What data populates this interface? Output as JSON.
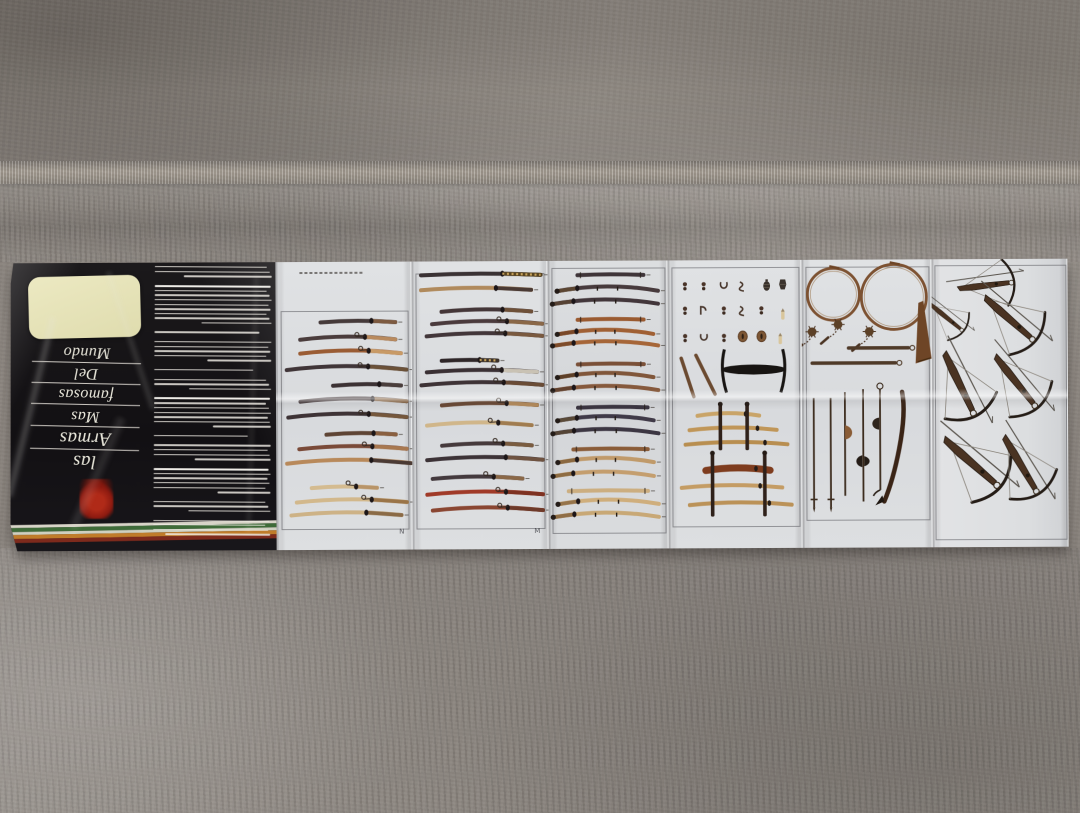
{
  "scene": {
    "alt": "Unfolded vintage weapons brochure lying upside-down on a gray carpet",
    "carpet_color": "#8d8781",
    "paper_color": "#dcdee0"
  },
  "brochure": {
    "cover": {
      "title_printed": "las Armas Mas famosas Del Mundo",
      "title_lines": [
        "Mundo",
        "Del",
        "famosas",
        "Mas",
        "Armas",
        "las"
      ],
      "background": "#141214",
      "cream_panel_color": "#e9e6bc",
      "emblem_color": "#9a1c10",
      "stripes": [
        "#d8d4c8",
        "#3e6b38",
        "#cfd0c0",
        "#c07c2a",
        "#7e2a1c"
      ],
      "stripe_heights": [
        3,
        4,
        3,
        4,
        4
      ],
      "text_block": {
        "line_color": "#f0ede5",
        "paragraphs": [
          {
            "n": 3,
            "last": 0.75
          },
          {
            "n": 9,
            "last": 0.6,
            "boldFirst": true
          },
          {
            "n": 1,
            "last": 0.9
          },
          {
            "n": 5,
            "last": 0.55
          },
          {
            "n": 1,
            "last": 0.85
          },
          {
            "n": 3,
            "last": 0.7
          },
          {
            "n": 7,
            "last": 0.5,
            "boldFirst": true
          },
          {
            "n": 1,
            "last": 0.8
          },
          {
            "n": 4,
            "last": 0.65
          },
          {
            "n": 6,
            "last": 0.45,
            "boldFirst": true
          },
          {
            "n": 3,
            "last": 0.7
          },
          {
            "n": 4,
            "last": 0.9
          }
        ]
      }
    },
    "plates": [
      {
        "id": "swords-plate-1",
        "corner_mark": "N",
        "w": 136,
        "border": {
          "l": 4,
          "t": 17,
          "r": 96.5,
          "b": 92.5
        },
        "caption": {
          "x": 18,
          "y": 3.6,
          "len": 46
        },
        "swords": [
          [
            21,
            33,
            88,
            "#453a3a",
            "#7d5a40",
            -1,
            ""
          ],
          [
            27,
            18,
            88,
            "#4a3c3c",
            "#b98a5e",
            -2,
            "t"
          ],
          [
            31.8,
            18,
            92,
            "#9a5c34",
            "#c89a66",
            -2,
            "t"
          ],
          [
            37.5,
            8,
            96,
            "#403538",
            "#6b5138",
            -2.5,
            "t"
          ],
          [
            43,
            42,
            92,
            "#3c3234",
            "#4a3e3c",
            -1,
            ""
          ],
          [
            48.5,
            18,
            96,
            "#453a3c",
            "#8a6848",
            -2,
            ""
          ],
          [
            54,
            9,
            96,
            "#3e3336",
            "#75573c",
            -2.5,
            "t"
          ],
          [
            60,
            37,
            88,
            "#5e4434",
            "#8a6040",
            -1,
            ""
          ],
          [
            65,
            17,
            96,
            "#7a4a38",
            "#a87850",
            -2,
            "t"
          ],
          [
            70,
            8,
            99,
            "#b8895a",
            "#4a3a34",
            -2.5,
            ""
          ],
          [
            78.5,
            26,
            74,
            "#d4bb90",
            "#b89468",
            -1,
            "t"
          ],
          [
            83.5,
            15,
            96,
            "#d2b88c",
            "#9a7448",
            -2,
            "t"
          ],
          [
            88,
            11,
            92,
            "#cdb286",
            "#8a6a46",
            -2,
            ""
          ]
        ]
      },
      {
        "id": "swords-plate-2",
        "corner_mark": "M",
        "w": 136,
        "border": {
          "l": 3,
          "t": 4,
          "r": 96,
          "b": 92.5
        },
        "swords": [
          [
            4.8,
            7,
            95,
            "#3a3234",
            "#57431f",
            -1,
            "b"
          ],
          [
            10,
            7,
            88,
            "#b08a5c",
            "#4a3a34",
            -1.5,
            ""
          ],
          [
            17.5,
            22,
            88,
            "#443638",
            "#6e5038",
            -1.5,
            ""
          ],
          [
            21.8,
            15,
            96,
            "#4a3a3c",
            "#8a6848",
            -2,
            "t"
          ],
          [
            26,
            11,
            96,
            "#42363a",
            "#7a5a40",
            -2,
            "t"
          ],
          [
            34.5,
            22,
            63,
            "#2e2628",
            "#3a3028",
            -0.5,
            "b"
          ],
          [
            38.5,
            11,
            92,
            "#3a3034",
            "#c9c2b4",
            -1.5,
            "t"
          ],
          [
            43,
            7,
            96,
            "#3e3336",
            "#6a4c36",
            -2,
            "t"
          ],
          [
            50,
            22,
            92,
            "#6a4834",
            "#b68c5c",
            -1.5,
            "t"
          ],
          [
            57,
            11,
            88,
            "#d0b68a",
            "#a07c50",
            -2,
            "t"
          ],
          [
            64,
            22,
            88,
            "#463a3c",
            "#7a5c40",
            -1.5,
            "t"
          ],
          [
            69,
            11,
            96,
            "#3c3236",
            "#6e5240",
            -2,
            ""
          ],
          [
            75.5,
            15,
            81,
            "#443a3e",
            "#8a6848",
            -1.5,
            "t"
          ],
          [
            81,
            11,
            96,
            "#a03a28",
            "#7e3222",
            -2,
            "t"
          ],
          [
            86.5,
            15,
            96,
            "#8a4632",
            "#6e3a2a",
            -2,
            "t"
          ]
        ]
      },
      {
        "id": "swords-plate-3",
        "corner_mark": "",
        "w": 120,
        "border": {
          "l": 3,
          "t": 2.5,
          "r": 97,
          "b": 94
        },
        "swords": [
          [
            5,
            25,
            80,
            "#3e3438",
            "#3e3438",
            -0.5,
            "s"
          ],
          [
            10.5,
            8,
            92,
            "#473a3c",
            "#5c4632",
            -3,
            "Lh"
          ],
          [
            15,
            4,
            92,
            "#42363a",
            "#564234",
            -3,
            "Lh"
          ],
          [
            20.5,
            25,
            80,
            "#9a5a30",
            "#9a5a30",
            -0.5,
            "s"
          ],
          [
            25.5,
            8,
            88,
            "#a06034",
            "#7a4828",
            -3,
            "Lh"
          ],
          [
            29.5,
            4,
            92,
            "#a66638",
            "#7e4c2a",
            -3,
            "Lh"
          ],
          [
            36,
            25,
            80,
            "#7a5038",
            "#7a5038",
            -0.5,
            "s"
          ],
          [
            40.5,
            8,
            88,
            "#80563a",
            "#5e4028",
            -3,
            "Lh"
          ],
          [
            45,
            4,
            92,
            "#86593c",
            "#634330",
            -3,
            "Lh"
          ],
          [
            51,
            25,
            83,
            "#3a3440",
            "#3a3440",
            -0.5,
            "s"
          ],
          [
            55.5,
            8,
            88,
            "#403a48",
            "#5a4a38",
            -3,
            "Lh"
          ],
          [
            60,
            4,
            92,
            "#3c3642",
            "#544436",
            -3,
            "Lh"
          ],
          [
            65.5,
            21,
            83,
            "#8a5c38",
            "#8a5c38",
            -0.5,
            "s"
          ],
          [
            70,
            8,
            88,
            "#c09a6a",
            "#8a6840",
            -3,
            "Lh"
          ],
          [
            74.8,
            4,
            88,
            "#c49e6e",
            "#8e6c42",
            -3,
            "Lh"
          ],
          [
            80,
            17,
            83,
            "#ccae80",
            "#ccae80",
            -0.5,
            "s"
          ],
          [
            84.5,
            8,
            92,
            "#cfae7c",
            "#96744a",
            -3,
            "Lh"
          ],
          [
            89,
            4,
            92,
            "#c8a876",
            "#906e46",
            -3,
            "Lh"
          ]
        ]
      },
      {
        "id": "fittings-and-racks-plate",
        "corner_mark": "",
        "w": 134,
        "border": {
          "l": 3,
          "t": 2.5,
          "r": 97,
          "b": 92
        },
        "fits": [
          [
            13,
            9,
            "knot"
          ],
          [
            27,
            9,
            "knot"
          ],
          [
            42,
            9,
            "stirrup"
          ],
          [
            57,
            9,
            "curve"
          ],
          [
            74,
            9,
            "grenade"
          ],
          [
            86,
            8.5,
            "vase"
          ],
          [
            13,
            17.5,
            "knot"
          ],
          [
            27,
            17.5,
            "hook"
          ],
          [
            42,
            17.5,
            "knot"
          ],
          [
            57,
            17.5,
            "curve"
          ],
          [
            70,
            17.5,
            "knot"
          ],
          [
            86,
            19,
            "bullet"
          ],
          [
            13,
            27,
            "knot"
          ],
          [
            27,
            27,
            "stirrup"
          ],
          [
            42,
            27,
            "knot"
          ],
          [
            56,
            26.5,
            "tsuba"
          ],
          [
            70,
            26.5,
            "tsuba"
          ],
          [
            84,
            27.5,
            "bullet"
          ]
        ],
        "sheaths": [
          [
            10,
            34,
            14,
            72
          ],
          [
            21,
            33,
            15,
            64
          ]
        ],
        "stand": {
          "cx": 64,
          "cy": 38,
          "rx": 24,
          "py1": 31,
          "py2": 46
        },
        "racks": [
          {
            "posts": [
              39,
              59
            ],
            "y1": 50,
            "y2": 66,
            "swords": [
              [
                54,
                22,
                68,
                "#c9a468"
              ],
              [
                59,
                16,
                81,
                "#c09658"
              ],
              [
                64,
                13,
                89,
                "#b88e50"
              ]
            ]
          },
          {
            "posts": [
              33,
              72
            ],
            "y1": 67,
            "y2": 89,
            "swords": [
              [
                73,
                28,
                76,
                "#7e3c1e",
                7
              ],
              [
                79,
                10,
                85,
                "#c49c64"
              ],
              [
                85,
                16,
                92,
                "#bb9258"
              ]
            ]
          }
        ]
      },
      {
        "id": "horns-maces-polearms-plate",
        "corner_mark": "",
        "w": 130,
        "border": {
          "l": 3,
          "t": 2.5,
          "r": 97,
          "b": 90
        },
        "horns": [
          {
            "cx": 24.5,
            "cy": 12,
            "r": 20,
            "bell": 0
          },
          {
            "cx": 71,
            "cy": 13,
            "r": 25,
            "bell": 1
          }
        ],
        "flails": [
          {
            "bx": 8,
            "by": 25
          },
          {
            "bx": 28,
            "by": 22.5
          },
          {
            "bx": 52,
            "by": 25
          }
        ],
        "batons": [
          [
            30.7,
            36,
            82
          ],
          [
            35.9,
            8,
            72
          ]
        ],
        "poles": [
          {
            "x": 9,
            "y1": 48,
            "y2": 86,
            "h": "cross"
          },
          {
            "x": 22,
            "y1": 48,
            "y2": 86,
            "h": "cross"
          },
          {
            "x": 33,
            "y1": 46,
            "y2": 82,
            "h": "fan",
            "hy": 60
          },
          {
            "x": 47,
            "y1": 45,
            "y2": 84,
            "h": "doubleaxe",
            "hy": 70
          },
          {
            "x": 60,
            "y1": 45,
            "y2": 80,
            "h": "axehook",
            "hy": 57,
            "ring": 1
          }
        ],
        "curvedaxe": {
          "x1": 77,
          "ys": 46,
          "x2": 63,
          "ye": 84
        }
      },
      {
        "id": "crossbows-plate",
        "corner_mark": "",
        "w": 136,
        "border": {
          "l": 2.5,
          "t": 2,
          "r": 97.5,
          "b": 97
        },
        "xbows": [
          [
            43,
            9,
            -6,
            0.8
          ],
          [
            13,
            21,
            40,
            0.6
          ],
          [
            60,
            22,
            42,
            0.95
          ],
          [
            22,
            45,
            65,
            1.0
          ],
          [
            64,
            44,
            52,
            0.95
          ],
          [
            32,
            72,
            42,
            1.05
          ],
          [
            67,
            73,
            60,
            0.95
          ]
        ]
      }
    ]
  }
}
